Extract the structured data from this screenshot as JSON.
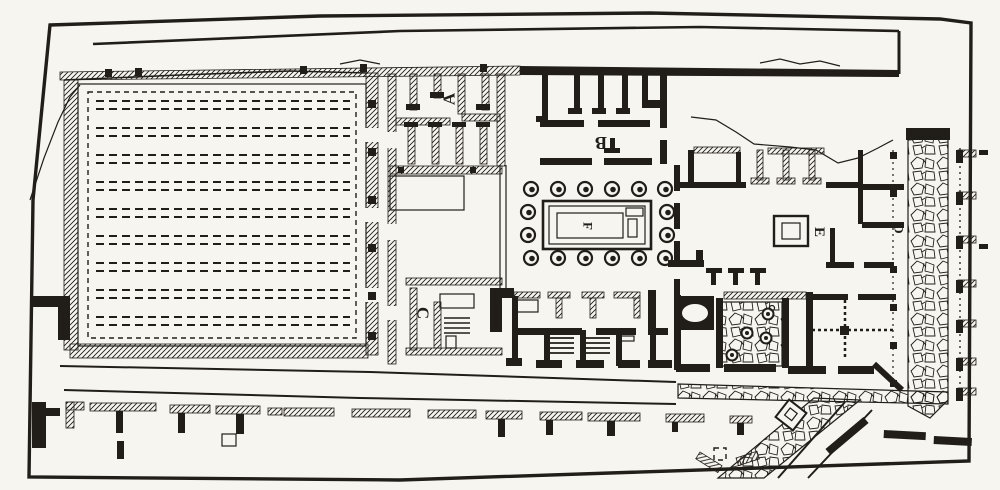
{
  "figure": {
    "kind": "engraved architectural plan",
    "labels": {
      "a": "A",
      "b": "B",
      "c": "C",
      "d": "D",
      "e": "E",
      "f": "F"
    },
    "colors": {
      "ink": "#211e19",
      "paper": "#f7f5f0"
    },
    "counts": {
      "planting_row_pairs": 9,
      "peristyle_columns": 16,
      "hearth_circles": 4,
      "portico_piers": 11,
      "side_colonnade_stubs": 7
    },
    "features": [
      "plan-frame",
      "top-street",
      "garden-plot-with-dashed-planting-rows",
      "west-house-rooms-A",
      "north-rooms-B",
      "peristyle-court-with-columns",
      "central-basin-F",
      "south-shops-with-stairs",
      "east-house-atrium",
      "altar-base-E",
      "kitchen-hearth-circles",
      "oval-basin",
      "rubble-lane-D",
      "right-street-colonnade",
      "bottom-street-with-portico-piers",
      "diagonal-rubble-lane",
      "eroded-north-east-corner"
    ]
  }
}
